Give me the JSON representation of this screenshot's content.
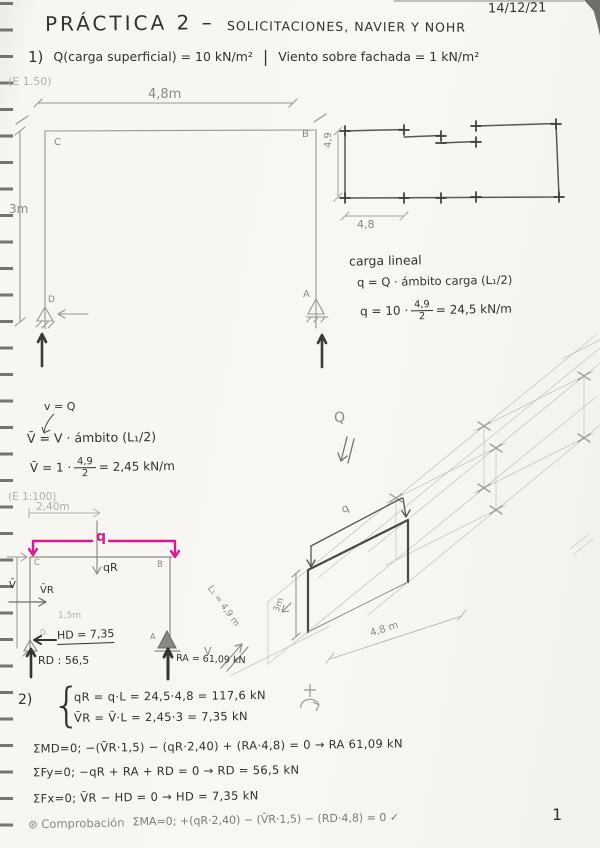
{
  "page": {
    "date": "14/12/21",
    "page_number": "1"
  },
  "header": {
    "title_main": "PRÁCTICA 2 –",
    "title_rest": "SOLICITACIONES, NAVIER Y NOHR"
  },
  "problem1": {
    "number": "1)",
    "load_statement": "Q(carga superficial) = 10 kN/m²",
    "divider": "|",
    "wind_statement": "Viento sobre fachada = 1 kN/m²",
    "scale": "(E 1.50)"
  },
  "frame_elevation": {
    "width_dim": "4,8m",
    "height_dim": "3m",
    "node_c": "C",
    "node_b": "B",
    "node_a": "A",
    "node_d": "D"
  },
  "floor_plan": {
    "depth_dim": "4,9",
    "bay_dim": "4,8"
  },
  "linear_load": {
    "heading": "carga lineal",
    "formula": "q = Q · ámbito carga (L₁/2)",
    "calc_prefix": "q = 10 ·",
    "frac_num": "4,9",
    "frac_den": "2",
    "calc_result": "= 24,5 kN/m"
  },
  "wind_load": {
    "note": "v = Q",
    "formula": "V̄ = V · ámbito (L₁/2)",
    "calc_prefix": "V̄ = 1 ·",
    "frac_num": "4,9",
    "frac_den": "2",
    "calc_result": "= 2,45 kN/m"
  },
  "frame_model": {
    "scale": "(E 1:100)",
    "top_dim": "2,40m",
    "load_label": "q",
    "qr_label": "qR",
    "vr_label": "V̄R",
    "v_label": "V̄",
    "height_dim": "1,5m",
    "node_c": "C",
    "node_b": "B",
    "node_a": "A",
    "node_d": "D",
    "hd_value": "HD = 7,35",
    "rd_value": "RD : 56,5",
    "ra_value": "RA = 61,09 kN",
    "wind_label": "V"
  },
  "isometric": {
    "load_area_label": "Q",
    "line_load_label": "q",
    "height_dim": "3m",
    "depth_dim": "L₁ = 4,9 m",
    "width_dim": "4,8 m"
  },
  "problem2": {
    "number": "2)",
    "resultant_q": "qR = q·L = 24,5·4,8 = 117,6 kN",
    "resultant_v": "V̄R = V̄·L = 2,45·3 = 7,35 kN",
    "moment_d": "ΣMD=0;  −(V̄R·1,5) − (qR·2,40) + (RA·4,8) = 0  →  RA 61,09 kN",
    "sum_fy": "ΣFy=0;  −qR + RA + RD = 0  →  RD = 56,5 kN",
    "sum_fx": "ΣFx=0;  V̄R − HD = 0  →  HD = 7,35 kN",
    "check_label": "⊛ Comprobación",
    "check_eq": "ΣMA=0; +(qR·2,40) − (V̄R·1,5) − (RD·4,8) = 0 ✓"
  },
  "colors": {
    "ink": "#33312d",
    "pencil": "#8c8881",
    "accent_pink": "#e0168e",
    "paper": "#f7f6f1"
  }
}
